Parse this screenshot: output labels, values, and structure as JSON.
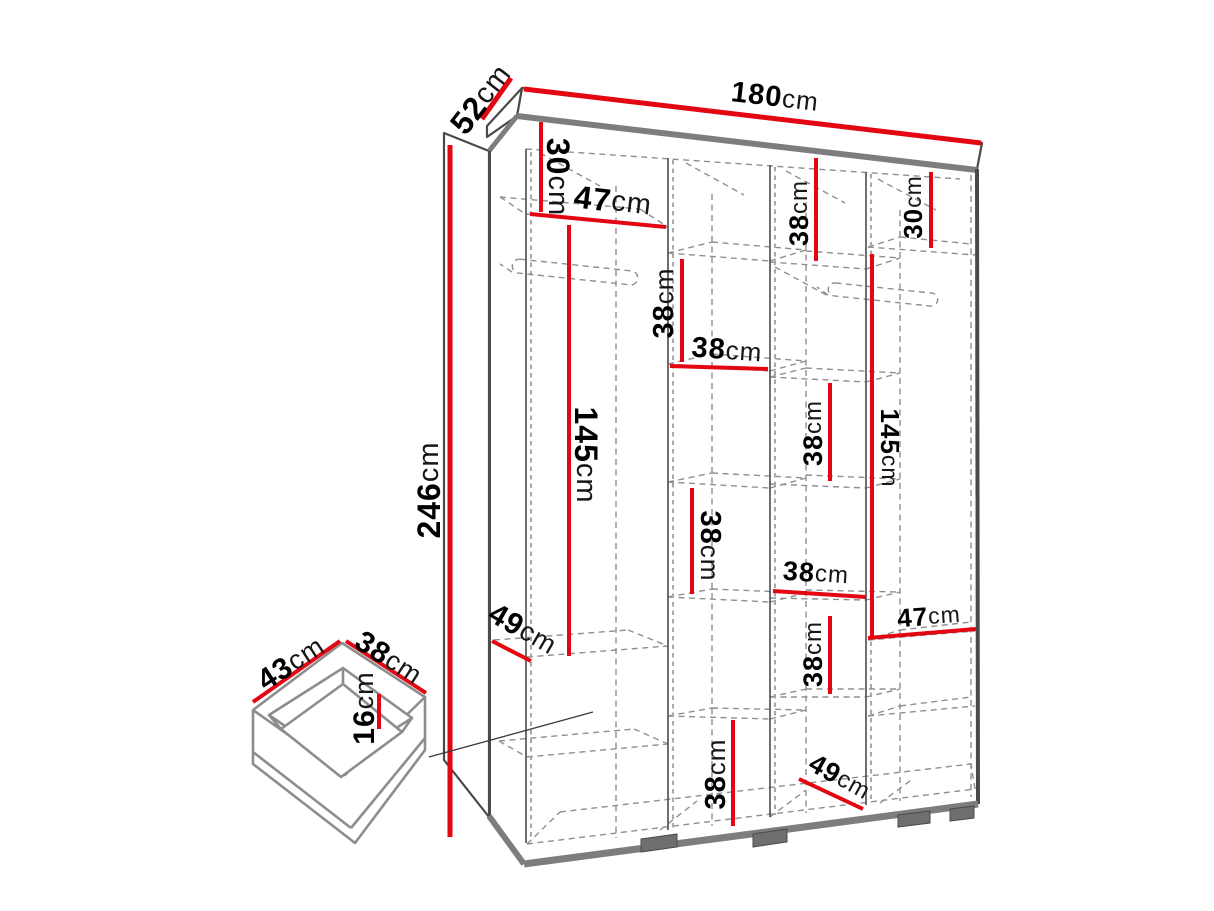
{
  "diagram": {
    "type": "furniture-dimension-drawing",
    "colors": {
      "dimension_line": "#e30613",
      "outline": "#4a4a4a",
      "panel_edge": "#7d7d7d",
      "dashed_interior": "#8f8f8f",
      "text": "#000000",
      "background": "#ffffff"
    }
  },
  "labels": [
    {
      "id": "wardrobe-depth",
      "value": "52",
      "unit": "cm"
    },
    {
      "id": "wardrobe-width",
      "value": "180",
      "unit": "cm"
    },
    {
      "id": "wardrobe-height",
      "value": "246",
      "unit": "cm"
    },
    {
      "id": "col1-top-section",
      "value": "30",
      "unit": "cm"
    },
    {
      "id": "col1-shelf-width",
      "value": "47",
      "unit": "cm"
    },
    {
      "id": "col1-hanging-section",
      "value": "145",
      "unit": "cm"
    },
    {
      "id": "col1-shelf-depth",
      "value": "49",
      "unit": "cm"
    },
    {
      "id": "col2-top-section",
      "value": "38",
      "unit": "cm"
    },
    {
      "id": "col2-shelf-width",
      "value": "38",
      "unit": "cm"
    },
    {
      "id": "col2-mid-section",
      "value": "38",
      "unit": "cm"
    },
    {
      "id": "col2-bottom-section",
      "value": "38",
      "unit": "cm"
    },
    {
      "id": "col3-top-section",
      "value": "38",
      "unit": "cm"
    },
    {
      "id": "col3-mid-section",
      "value": "38",
      "unit": "cm"
    },
    {
      "id": "col3-shelf-width",
      "value": "38",
      "unit": "cm"
    },
    {
      "id": "col3-lower-section",
      "value": "38",
      "unit": "cm"
    },
    {
      "id": "col3-floor-depth",
      "value": "49",
      "unit": "cm"
    },
    {
      "id": "col4-top-section",
      "value": "30",
      "unit": "cm"
    },
    {
      "id": "col4-hanging-section",
      "value": "145",
      "unit": "cm"
    },
    {
      "id": "col4-shelf-width",
      "value": "47",
      "unit": "cm"
    },
    {
      "id": "drawer-width",
      "value": "43",
      "unit": "cm"
    },
    {
      "id": "drawer-depth",
      "value": "38",
      "unit": "cm"
    },
    {
      "id": "drawer-height",
      "value": "16",
      "unit": "cm"
    }
  ]
}
